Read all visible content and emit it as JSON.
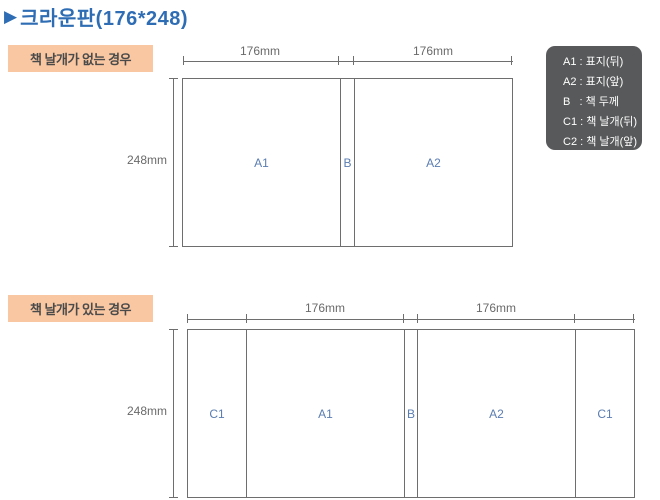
{
  "page": {
    "title": "크라운판(176*248)"
  },
  "colors": {
    "title_blue": "#2e6db4",
    "case_label_bg": "#f9c7a2",
    "line_gray": "#6e6e6e",
    "section_label_blue": "#5b7db1",
    "legend_bg": "#58595b",
    "legend_text": "#ffffff"
  },
  "legend": {
    "items": {
      "a1": "A1 : 표지(뒤)",
      "a2": "A2 : 표지(앞)",
      "b": "B   : 책 두께",
      "c1": "C1 : 책 날개(뒤)",
      "c2": "C2 : 책 날개(앞)"
    }
  },
  "diagram_no_flaps": {
    "case_label": "책 날개가 없는 경우",
    "width_label_left": "176mm",
    "width_label_right": "176mm",
    "height_label": "248mm",
    "sections": {
      "a1": "A1",
      "b": "B",
      "a2": "A2"
    }
  },
  "diagram_with_flaps": {
    "case_label": "책 날개가 있는 경우",
    "width_label_left": "176mm",
    "width_label_right": "176mm",
    "height_label": "248mm",
    "sections": {
      "c1_left": "C1",
      "a1": "A1",
      "b": "B",
      "a2": "A2",
      "c1_right": "C1"
    }
  }
}
